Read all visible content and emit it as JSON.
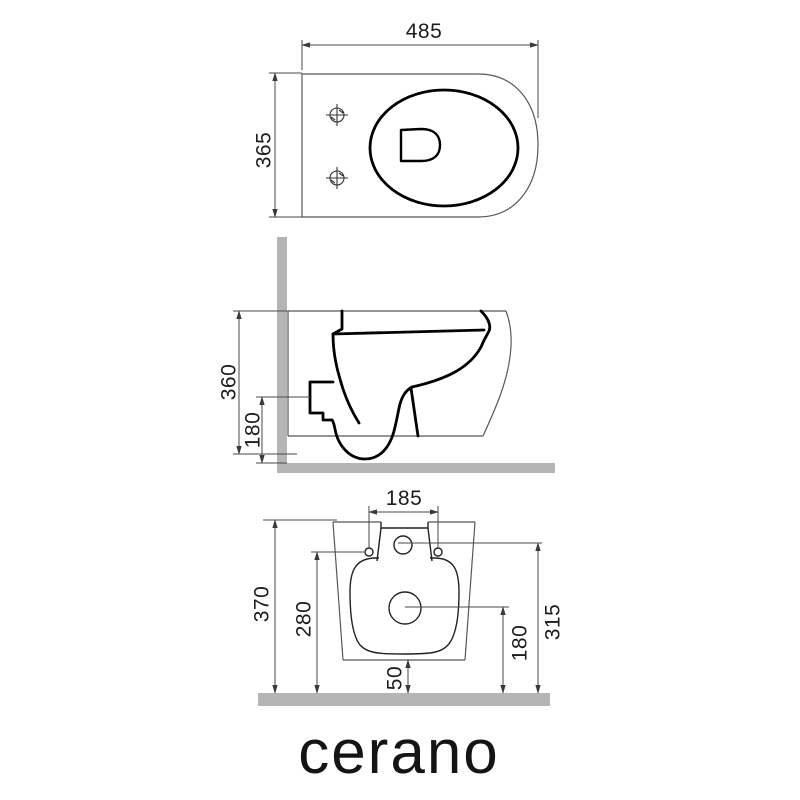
{
  "logo": "cerano",
  "colors": {
    "line_thick": "#000000",
    "line_thin": "#565656",
    "dimension_line": "#4a4a4a",
    "wall_floor_bar": "#b5b5b5",
    "background": "#ffffff"
  },
  "top_view": {
    "name": "top view",
    "width_mm": "485",
    "depth_mm": "365"
  },
  "side_view": {
    "name": "side view",
    "height_mm": "360",
    "outlet_height_mm": "180"
  },
  "rear_view": {
    "name": "rear view",
    "hole_spacing_mm": "185",
    "total_height_mm": "370",
    "hole_height_mm": "280",
    "inlet_height_mm": "315",
    "drain_height_mm": "180",
    "bottom_clearance_mm": "50"
  }
}
